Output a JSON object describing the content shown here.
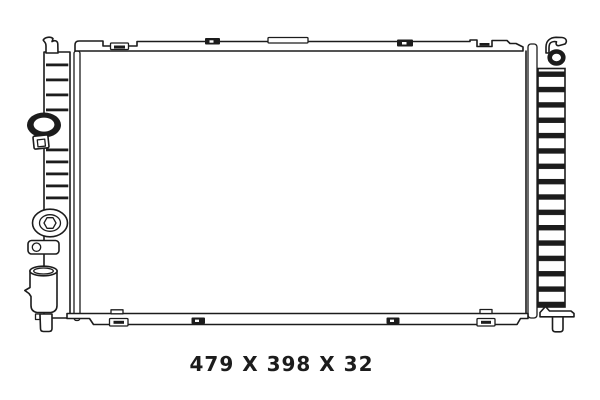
{
  "canvas": {
    "width": 600,
    "height": 400,
    "background": "#ffffff",
    "ink": "#1c1c1c"
  },
  "figure": {
    "kind": "radiator technical line drawing",
    "caption": "479 X 398 X 32"
  }
}
